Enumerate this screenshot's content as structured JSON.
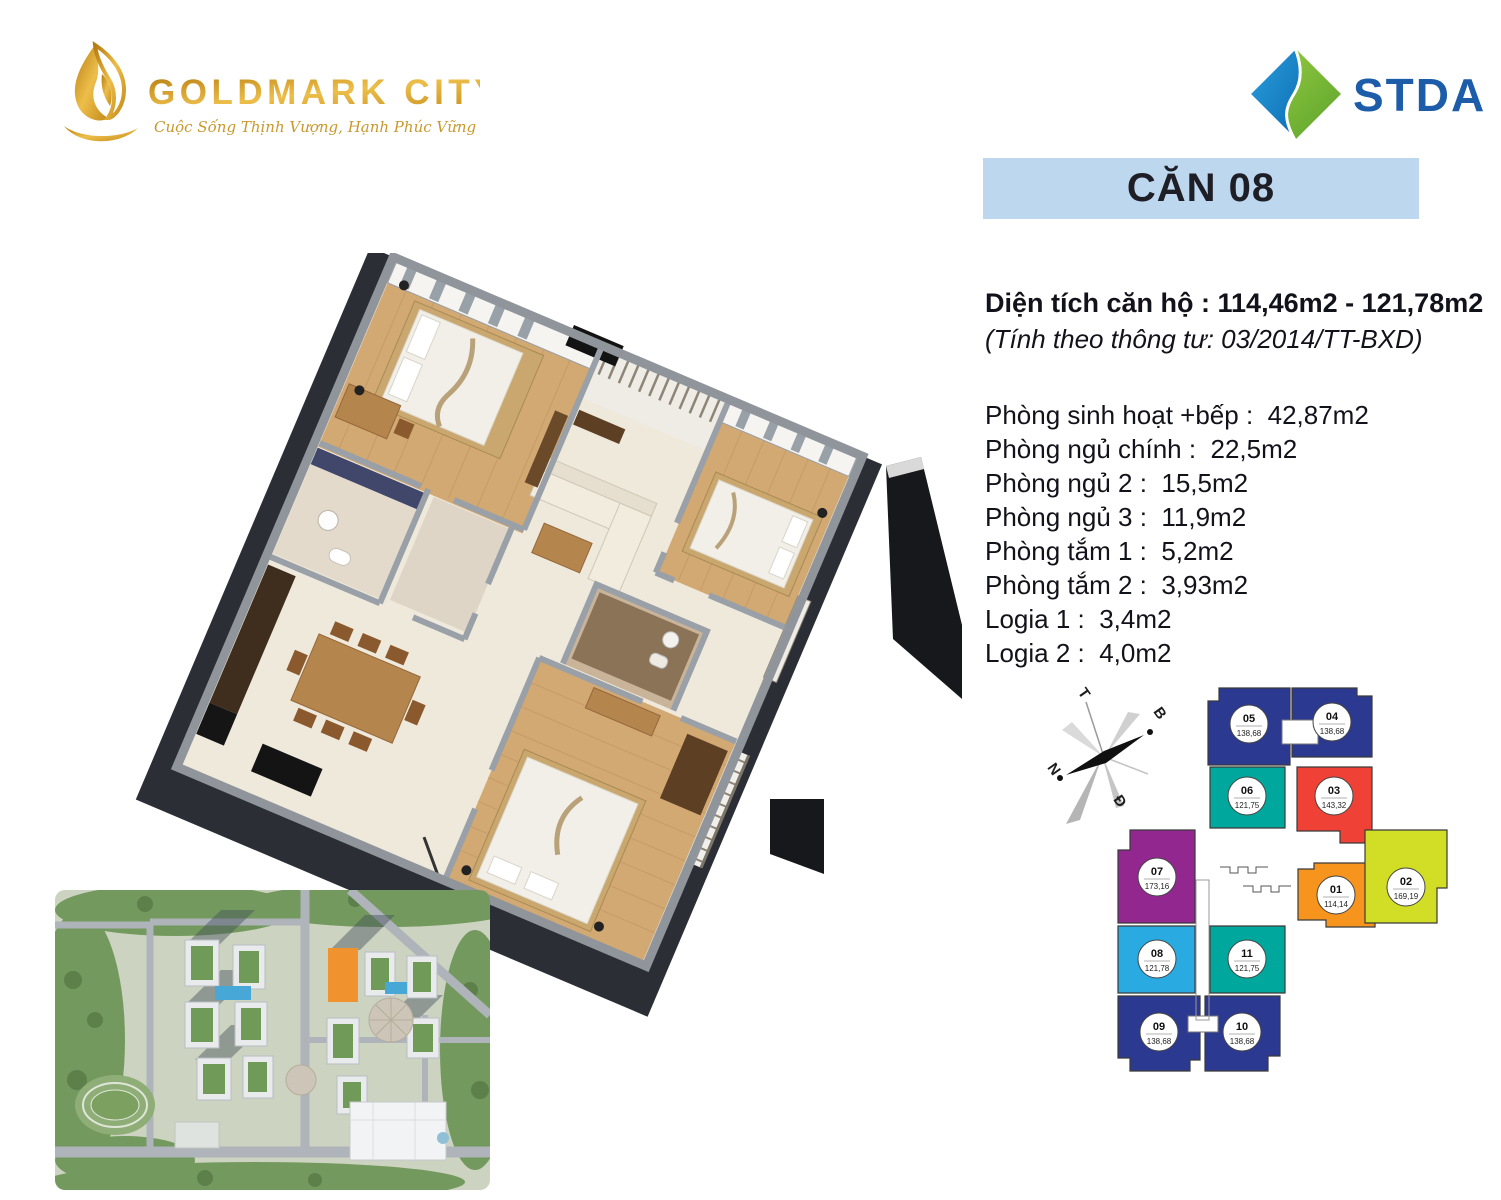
{
  "brand": {
    "name": "GOLDMARK CITY",
    "tagline": "Cuộc Sống Thịnh Vượng, Hạnh Phúc Vững Bền"
  },
  "agency": {
    "name": "STDA"
  },
  "unit_banner": {
    "title": "CĂN 08"
  },
  "area_summary": {
    "line1": "Diện tích căn hộ : 114,46m2 - 121,78m2",
    "line2": "(Tính theo thông tư: 03/2014/TT-BXD)"
  },
  "rooms": [
    {
      "label": "Phòng sinh hoạt +bếp",
      "area": "42,87m2"
    },
    {
      "label": "Phòng ngủ chính",
      "area": "22,5m2"
    },
    {
      "label": "Phòng ngủ 2",
      "area": "15,5m2"
    },
    {
      "label": "Phòng ngủ 3",
      "area": "11,9m2"
    },
    {
      "label": "Phòng tắm 1",
      "area": "5,2m2"
    },
    {
      "label": "Phòng tắm 2",
      "area": "3,93m2"
    },
    {
      "label": "Logia 1",
      "area": "3,4m2"
    },
    {
      "label": "Logia 2",
      "area": "4,0m2"
    }
  ],
  "compass": {
    "west": "T",
    "north": "B",
    "south": "N",
    "east": "Đ"
  },
  "floor_plate": {
    "units": [
      {
        "id": "05",
        "area": "138,68",
        "color": "#2B3990"
      },
      {
        "id": "04",
        "area": "138,68",
        "color": "#2B3990"
      },
      {
        "id": "06",
        "area": "121,75",
        "color": "#00A79D"
      },
      {
        "id": "03",
        "area": "143,32",
        "color": "#EF4136"
      },
      {
        "id": "07",
        "area": "173,16",
        "color": "#92278F"
      },
      {
        "id": "01",
        "area": "114,14",
        "color": "#F7941E"
      },
      {
        "id": "02",
        "area": "169,19",
        "color": "#D2DE26"
      },
      {
        "id": "08",
        "area": "121,78",
        "color": "#29ABE2"
      },
      {
        "id": "11",
        "area": "121,75",
        "color": "#00A79D"
      },
      {
        "id": "09",
        "area": "138,68",
        "color": "#2B3990"
      },
      {
        "id": "10",
        "area": "138,68",
        "color": "#2B3990"
      }
    ],
    "highlighted_unit": "08"
  },
  "colors": {
    "banner_bg": "#BCD7EE",
    "text_dark": "#12121A",
    "gold": "#D39B2C",
    "stda_blue": "#1C5CA8",
    "stda_green": "#7DBB42",
    "highlight": "#29ABE2"
  }
}
